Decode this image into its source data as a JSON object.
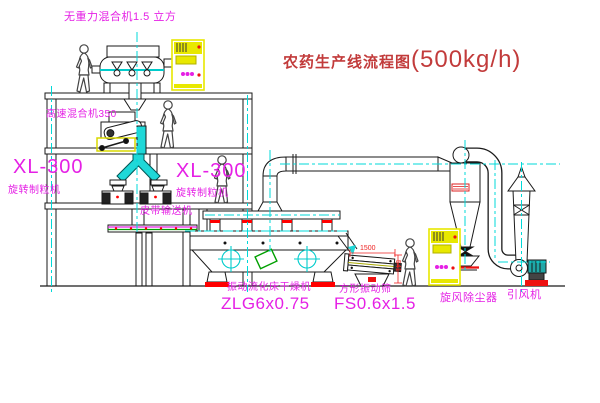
{
  "title": {
    "name_cn": "农药生产线流程图",
    "capacity": "(500kg/h)"
  },
  "equipment_labels": {
    "gravity_mixer": "无重力混合机1.5 立方",
    "high_speed_mixer": "高速混合机350",
    "granulator_left": {
      "model": "XL-300",
      "name": "旋转制粒机"
    },
    "granulator_right": {
      "model": "XL-300",
      "name": "旋转制粒机"
    },
    "belt_conveyor": "皮带输送机",
    "fluid_bed_dryer": {
      "name": "振动流化床干燥机",
      "model": "ZLG6x0.75"
    },
    "vibrating_sieve": {
      "name": "方形振动筛",
      "model": "FS0.6x1.5"
    },
    "cyclone": "旋风除尘器",
    "induced_draft_fan": "引风机"
  },
  "dimensions": {
    "sieve_length": "1500",
    "sieve_outlet_height": "541"
  },
  "colors": {
    "title_red": "#c23b3b",
    "label_magenta": "#e520e5",
    "centerline_cyan": "#00d8d8",
    "cabinet_yellow": "#e8e800",
    "accent_red": "#ff0000",
    "accent_green": "#00a000"
  }
}
